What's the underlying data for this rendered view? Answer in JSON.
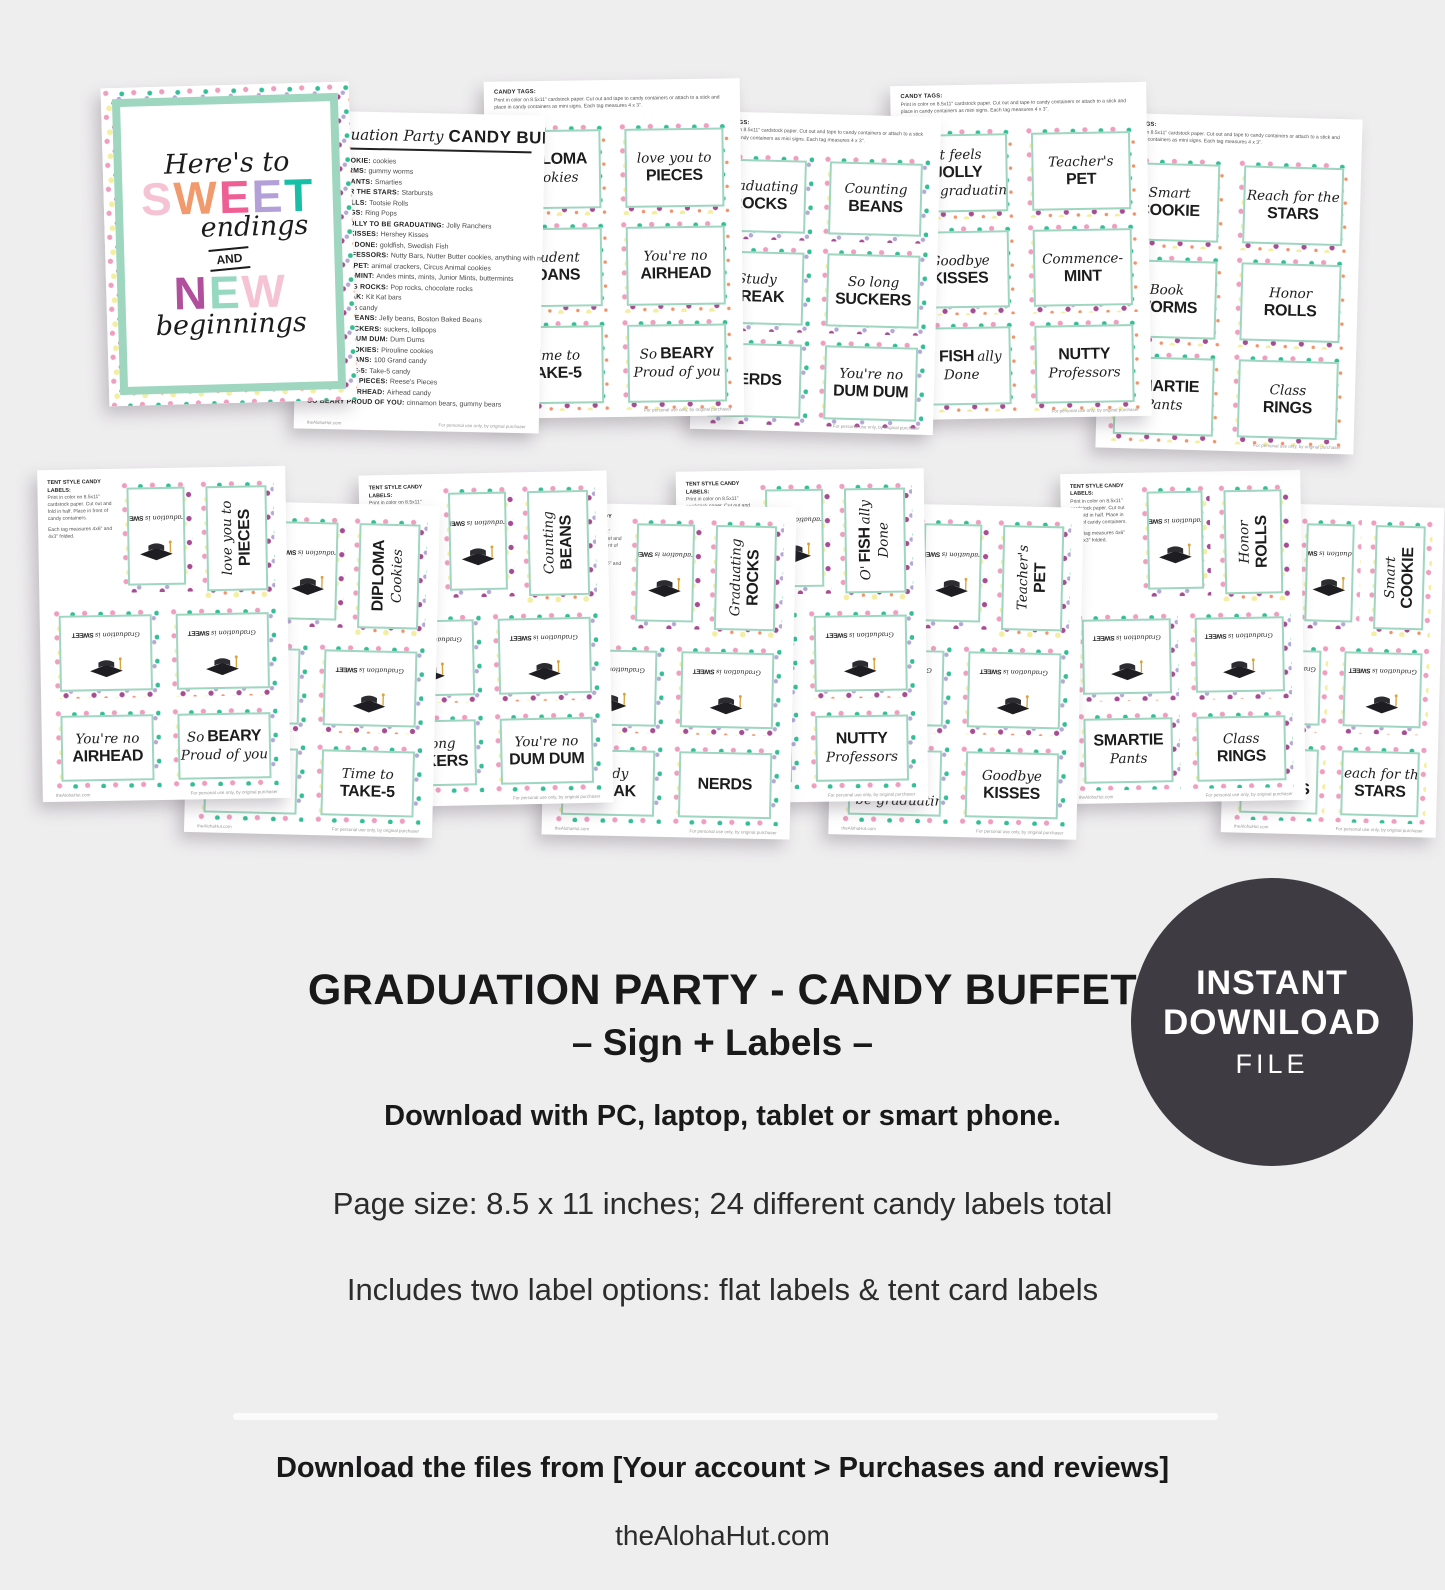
{
  "colors": {
    "bg": "#efeeef",
    "mint": "#9ed6bf",
    "ink": "#1d1d1d",
    "badge_bg": "#3e3c42",
    "badge_fg": "#ffffff",
    "confetti": [
      "#ef9ec0",
      "#a64d92",
      "#35bd96",
      "#f3eea0",
      "#b5a8d6",
      "#f0936b"
    ]
  },
  "sign": {
    "line1": "Here's to",
    "sweet": [
      [
        "S",
        "#f6c3d5"
      ],
      [
        "W",
        "#f09a6d"
      ],
      [
        "E",
        "#ee5f94"
      ],
      [
        "E",
        "#b3a0d8"
      ],
      [
        "T",
        "#17bfa6"
      ]
    ],
    "line2": "endings",
    "amp": "AND",
    "neww": [
      [
        "N",
        "#b0509c"
      ],
      [
        "E",
        "#96d8c0"
      ],
      [
        "W",
        "#f6c3d5"
      ]
    ],
    "line3": "beginnings"
  },
  "list_page": {
    "title_script": "Graduation Party",
    "title_block": "CANDY BUFFET",
    "items": [
      [
        "SMART COOKIE",
        "cookies"
      ],
      [
        "BOOK WORMS",
        "gummy worms"
      ],
      [
        "SMARTIE PANTS",
        "Smarties"
      ],
      [
        "REACH FOR THE STARS",
        "Starbursts"
      ],
      [
        "HONOR ROLLS",
        "Tootsie Rolls"
      ],
      [
        "CLASS RINGS",
        "Ring Pops"
      ],
      [
        "IT FEELS JOLLY TO BE GRADUATING",
        "Jolly Ranchers"
      ],
      [
        "GOODBYE KISSES",
        "Hershey Kisses"
      ],
      [
        "O'FISHALLY DONE",
        "goldfish, Swedish Fish"
      ],
      [
        "NUTTY PROFESSORS",
        "Nutty Bars, Nutter Butter cookies, anything with nuts"
      ],
      [
        "TEACHER'S PET",
        "animal crackers, Circus Animal cookies"
      ],
      [
        "COMMENCE-MINT",
        "Andes mints, mints, Junior Mints, buttermints"
      ],
      [
        "GRADUATING ROCKS",
        "Pop rocks, chocolate rocks"
      ],
      [
        "STUDY BREAK",
        "Kit Kat bars"
      ],
      [
        "NERDS",
        "Nerds candy"
      ],
      [
        "COUNTING BEANS",
        "Jelly beans, Boston Baked Beans"
      ],
      [
        "SO LONG SUCKERS",
        "suckers, lollipops"
      ],
      [
        "YOU'RE NO DUM DUM",
        "Dum Dums"
      ],
      [
        "DIPLOMA COOKIES",
        "Pirouline cookies"
      ],
      [
        "STUDENT LOANS",
        "100 Grand candy"
      ],
      [
        "TIME TO TAKE-5",
        "Take-5 candy"
      ],
      [
        "LOVE YOU TO PIECES",
        "Reese's Pieces"
      ],
      [
        "YOU'RE NO AIRHEAD",
        "Airhead candy"
      ],
      [
        "SO BEARY PROUD OF YOU",
        "cinnamon bears, gummy bears"
      ]
    ],
    "footer_left": "theAlohaHut.com",
    "footer_right": "For personal use only, by original purchaser"
  },
  "labels": {
    "diploma_cookies": [
      [
        [
          "DIPLOMA",
          "b"
        ]
      ],
      [
        [
          "Cookies",
          "s"
        ]
      ]
    ],
    "love_you_to_pieces": [
      [
        [
          "love you to",
          "s"
        ]
      ],
      [
        [
          "PIECES",
          "b"
        ]
      ]
    ],
    "student_loans": [
      [
        [
          "Student",
          "s"
        ]
      ],
      [
        [
          "LOANS",
          "b"
        ]
      ]
    ],
    "youre_no_airhead": [
      [
        [
          "You're no",
          "s"
        ]
      ],
      [
        [
          "AIRHEAD",
          "b"
        ]
      ]
    ],
    "time_to_take5": [
      [
        [
          "Time to",
          "s"
        ]
      ],
      [
        [
          "TAKE-5",
          "b"
        ]
      ]
    ],
    "so_beary": [
      [
        [
          "So",
          "s"
        ],
        [
          "BEARY",
          "b"
        ]
      ],
      [
        [
          "Proud of you",
          "s"
        ]
      ]
    ],
    "graduating_rocks": [
      [
        [
          "Graduating",
          "s"
        ]
      ],
      [
        [
          "ROCKS",
          "b"
        ]
      ]
    ],
    "counting_beans": [
      [
        [
          "Counting",
          "s"
        ]
      ],
      [
        [
          "BEANS",
          "b"
        ]
      ]
    ],
    "study_break": [
      [
        [
          "Study",
          "s"
        ]
      ],
      [
        [
          "BREAK",
          "b"
        ]
      ]
    ],
    "so_long_suckers": [
      [
        [
          "So long",
          "s"
        ]
      ],
      [
        [
          "SUCKERS",
          "b"
        ]
      ]
    ],
    "nerds": [
      [
        [
          "NERDS",
          "b"
        ]
      ]
    ],
    "dum_dum": [
      [
        [
          "You're no",
          "s"
        ]
      ],
      [
        [
          "DUM DUM",
          "b"
        ]
      ]
    ],
    "jolly": [
      [
        [
          "It feels",
          "s"
        ]
      ],
      [
        [
          "JOLLY",
          "b"
        ]
      ],
      [
        [
          "to be graduating",
          "s"
        ]
      ]
    ],
    "teachers_pet": [
      [
        [
          "Teacher's",
          "s"
        ]
      ],
      [
        [
          "PET",
          "b"
        ]
      ]
    ],
    "goodbye_kisses": [
      [
        [
          "Goodbye",
          "s"
        ]
      ],
      [
        [
          "KISSES",
          "b"
        ]
      ]
    ],
    "commence_mint": [
      [
        [
          "Commence-",
          "s"
        ]
      ],
      [
        [
          "MINT",
          "b"
        ]
      ]
    ],
    "ofishally": [
      [
        [
          "O'",
          "s"
        ],
        [
          "FISH",
          "b"
        ],
        [
          "ally",
          "s"
        ]
      ],
      [
        [
          "Done",
          "s"
        ]
      ]
    ],
    "nutty": [
      [
        [
          "NUTTY",
          "b"
        ]
      ],
      [
        [
          "Professors",
          "s"
        ]
      ]
    ],
    "smart_cookie": [
      [
        [
          "Smart",
          "s"
        ]
      ],
      [
        [
          "COOKIE",
          "b"
        ]
      ]
    ],
    "stars": [
      [
        [
          "Reach for the",
          "s"
        ]
      ],
      [
        [
          "STARS",
          "b"
        ]
      ]
    ],
    "book_worms": [
      [
        [
          "Book",
          "s"
        ]
      ],
      [
        [
          "WORMS",
          "b"
        ]
      ]
    ],
    "honor_rolls": [
      [
        [
          "Honor",
          "s"
        ]
      ],
      [
        [
          "ROLLS",
          "b"
        ]
      ]
    ],
    "smartie_pants": [
      [
        [
          "SMARTIE",
          "b"
        ]
      ],
      [
        [
          "Pants",
          "s"
        ]
      ]
    ],
    "class_rings": [
      [
        [
          "Class",
          "s"
        ]
      ],
      [
        [
          "RINGS",
          "b"
        ]
      ]
    ]
  },
  "tag_pages": {
    "header_bold": "CANDY TAGS:",
    "header_text": "Print in color on 8.5x11\" cardstock paper. Cut out and tape to candy containers or attach to a stick and place in candy containers as mini signs. Each tag measures 4 x 3\".",
    "pages": [
      [
        "diploma_cookies",
        "love_you_to_pieces",
        "student_loans",
        "youre_no_airhead",
        "time_to_take5",
        "so_beary"
      ],
      [
        "graduating_rocks",
        "counting_beans",
        "study_break",
        "so_long_suckers",
        "nerds",
        "dum_dum"
      ],
      [
        "jolly",
        "teachers_pet",
        "goodbye_kisses",
        "commence_mint",
        "ofishally",
        "nutty"
      ],
      [
        "smart_cookie",
        "stars",
        "book_worms",
        "honor_rolls",
        "smartie_pants",
        "class_rings"
      ]
    ],
    "footer_right": "For personal use only, by original purchaser"
  },
  "tent_pages": {
    "header_bold": "TENT STYLE CANDY LABELS:",
    "header_text": "Print in color on 8.5x11\" cardstock paper. Cut out and fold in half. Place in front of candy containers.",
    "header_text2": "Each tag measures 4x6\" and 4x3\" folded.",
    "back_script": "Graduation is",
    "back_block": "SWEET",
    "pages": [
      {
        "rot": "love_you_to_pieces",
        "bottom": [
          "youre_no_airhead",
          "so_beary"
        ]
      },
      {
        "rot": "diploma_cookies",
        "bottom": [
          "student_loans",
          "time_to_take5"
        ]
      },
      {
        "rot": "counting_beans",
        "bottom": [
          "so_long_suckers",
          "dum_dum"
        ]
      },
      {
        "rot": "graduating_rocks",
        "bottom": [
          "study_break",
          "nerds"
        ]
      },
      {
        "rot": "ofishally",
        "bottom": [
          "commence_mint",
          "nutty"
        ]
      },
      {
        "rot": "teachers_pet",
        "bottom": [
          "jolly",
          "goodbye_kisses"
        ]
      },
      {
        "rot": "honor_rolls",
        "bottom": [
          "smartie_pants",
          "class_rings"
        ]
      },
      {
        "rot": "smart_cookie",
        "bottom": [
          "book_worms",
          "stars"
        ]
      }
    ],
    "footer_left": "theAlohaHut.com",
    "footer_right": "For personal use only, by original purchaser"
  },
  "details": {
    "title": "GRADUATION PARTY - CANDY BUFFET",
    "subtitle": "– Sign + Labels –",
    "line1": "Download with PC, laptop, tablet or smart phone.",
    "line2": "Page size: 8.5 x 11 inches; 24 different candy labels total",
    "line3": "Includes two label options: flat labels & tent card labels",
    "download_note": "Download the files from [Your account > Purchases and reviews]",
    "site": "theAlohaHut.com"
  },
  "badge": {
    "line1": "INSTANT",
    "line2": "DOWNLOAD",
    "line3": "FILE"
  }
}
